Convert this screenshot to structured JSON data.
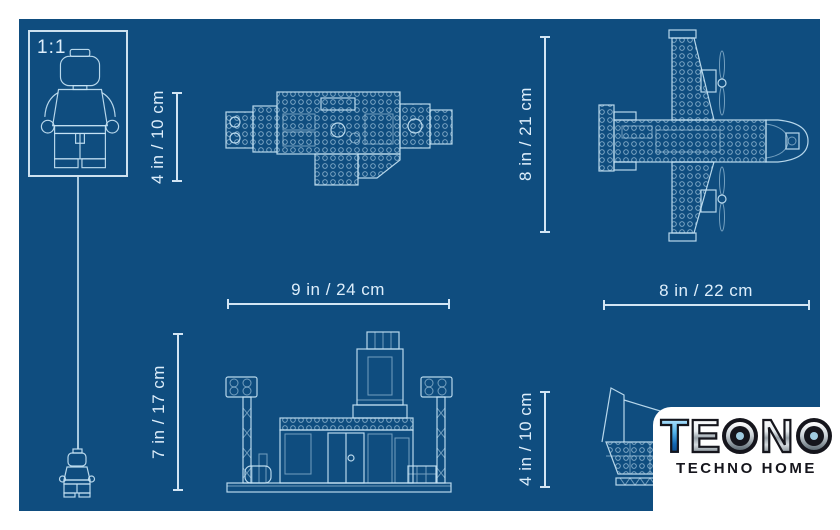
{
  "colors": {
    "page_bg": "#ffffff",
    "blueprint_bg": "#0f4d7f",
    "line_color": "#c6e3f4",
    "dim_color": "#ddeefb",
    "logo_dark": "#15151c"
  },
  "scale_box": {
    "label": "1:1"
  },
  "dimensions": {
    "base_top_height": "4 in / 10 cm",
    "plane_top_height": "8 in / 21 cm",
    "base_width": "9 in / 24 cm",
    "plane_width": "8 in / 22 cm",
    "base_front_height": "7 in / 17 cm",
    "plane_side_height": "4 in / 10 cm"
  },
  "logo": {
    "brand": "TEONO",
    "letters": [
      "T",
      "E",
      "O",
      "N",
      "O"
    ],
    "subtitle": "TECHNO HOME"
  }
}
